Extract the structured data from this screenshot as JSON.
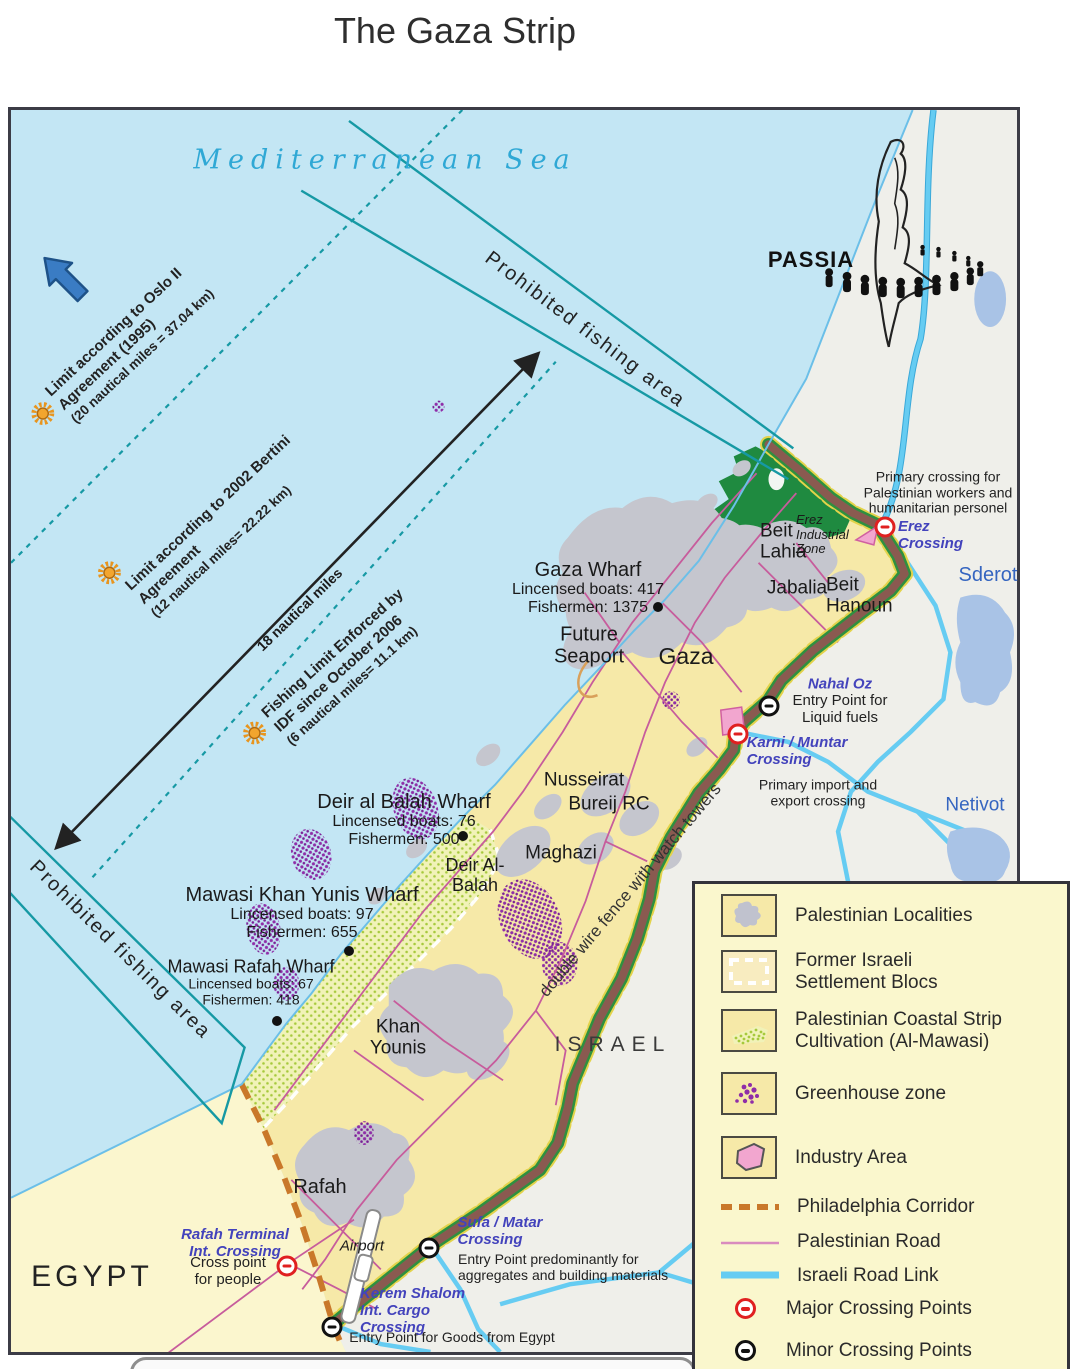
{
  "title": "The Gaza Strip",
  "sea_label": "Mediterranean Sea",
  "passia_label": "PASSIA",
  "annotations": {
    "oslo": [
      "Limit according to Oslo II",
      "Agreement (1995)",
      "(20 nautical miles = 37.04 km)"
    ],
    "bertini": [
      "Limit according to 2002 Bertini",
      "Agreement",
      "(12 nautical miles= 22.22 km)"
    ],
    "idf": [
      "Fishing Limit Enforced by",
      "IDF since October 2006",
      "(6 nautical miles= 11.1 km)"
    ],
    "nm18": "18 nautical miles",
    "prohibited_north": "Prohibited fishing area",
    "prohibited_south": "Prohibited fishing area",
    "fence": "double wire fence with watch towers"
  },
  "wharves": [
    {
      "name": "Gaza Wharf",
      "boats": "Lincensed boats: 417",
      "fishermen": "Fishermen: 1375"
    },
    {
      "name": "Deir al Balah Wharf",
      "boats": "Lincensed boats: 76",
      "fishermen": "Fishermen: 500"
    },
    {
      "name": "Mawasi Khan Yunis Wharf",
      "boats": "Lincensed boats: 97",
      "fishermen": "Fishermen: 655"
    },
    {
      "name": "Mawasi Rafah Wharf",
      "boats": "Lincensed boats: 67",
      "fishermen": "Fishermen: 418"
    }
  ],
  "places": {
    "gaza": "Gaza",
    "beit_lahia": "Beit Lahia",
    "jabalia": "Jabalia",
    "beit_hanoun": "Beit Hanoun",
    "erez_zone": "Erez Industrial Zone",
    "future_seaport": "Future Seaport",
    "nusseirat": "Nusseirat",
    "bureij": "Bureij RC",
    "maghazi": "Maghazi",
    "deir_al_balah": "Deir Al-Balah",
    "khan_younis": "Khan Younis",
    "rafah": "Rafah",
    "israel": "ISRAEL",
    "egypt": "EGYPT",
    "sderot": "Sderot",
    "netivot": "Netivot",
    "airport": "Airport"
  },
  "crossings": {
    "erez": {
      "name": "Erez Crossing",
      "note": [
        "Primary crossing for",
        "Palestinian workers and",
        "humanitarian personel"
      ]
    },
    "nahal_oz": {
      "name": "Nahal Oz",
      "note": [
        "Entry Point for",
        "Liquid fuels"
      ]
    },
    "karni": {
      "name": [
        "Karni / Muntar",
        "Crossing"
      ],
      "note": [
        "Primary import and",
        "export crossing"
      ]
    },
    "rafah": {
      "name": [
        "Rafah Terminal",
        "Int. Crossing"
      ],
      "note": [
        "Cross point",
        "for people"
      ]
    },
    "sufa": {
      "name": [
        "Sufa / Matar",
        "Crossing"
      ],
      "note": [
        "Entry Point predominantly for",
        "aggregates and building materials"
      ]
    },
    "kerem": {
      "name": [
        "Kerem Shalom",
        "Int. Cargo",
        "Crossing"
      ],
      "note": "Entry Point for Goods from Egypt"
    }
  },
  "legend": {
    "items": [
      "Palestinian Localities",
      "Former Israeli\nSettlement Blocs",
      "Palestinian Coastal Strip\nCultivation (Al-Mawasi)",
      "Greenhouse zone",
      "Industry Area",
      "Philadelphia Corridor",
      "Palestinian Road",
      "Israeli Road Link",
      "Major Crossing Points",
      "Minor Crossing Points"
    ]
  },
  "colors": {
    "sea": "#C3E6F4",
    "israel_land": "#EFEFEA",
    "gaza_land": "#F6E9A8",
    "egypt_land": "#FBF6CE",
    "fishing_line": "#1699A4",
    "fence_brown": "#8A5A50",
    "border_green": "#2E9040",
    "palestinian_road": "#C75C9C",
    "israeli_road": "#66CCF2",
    "greenhouse": "#8F2DA8",
    "industry": "#F2A6CF",
    "philadelphia": "#C9782A",
    "crossing_major": "#E02020",
    "crossing_minor": "#111111"
  }
}
